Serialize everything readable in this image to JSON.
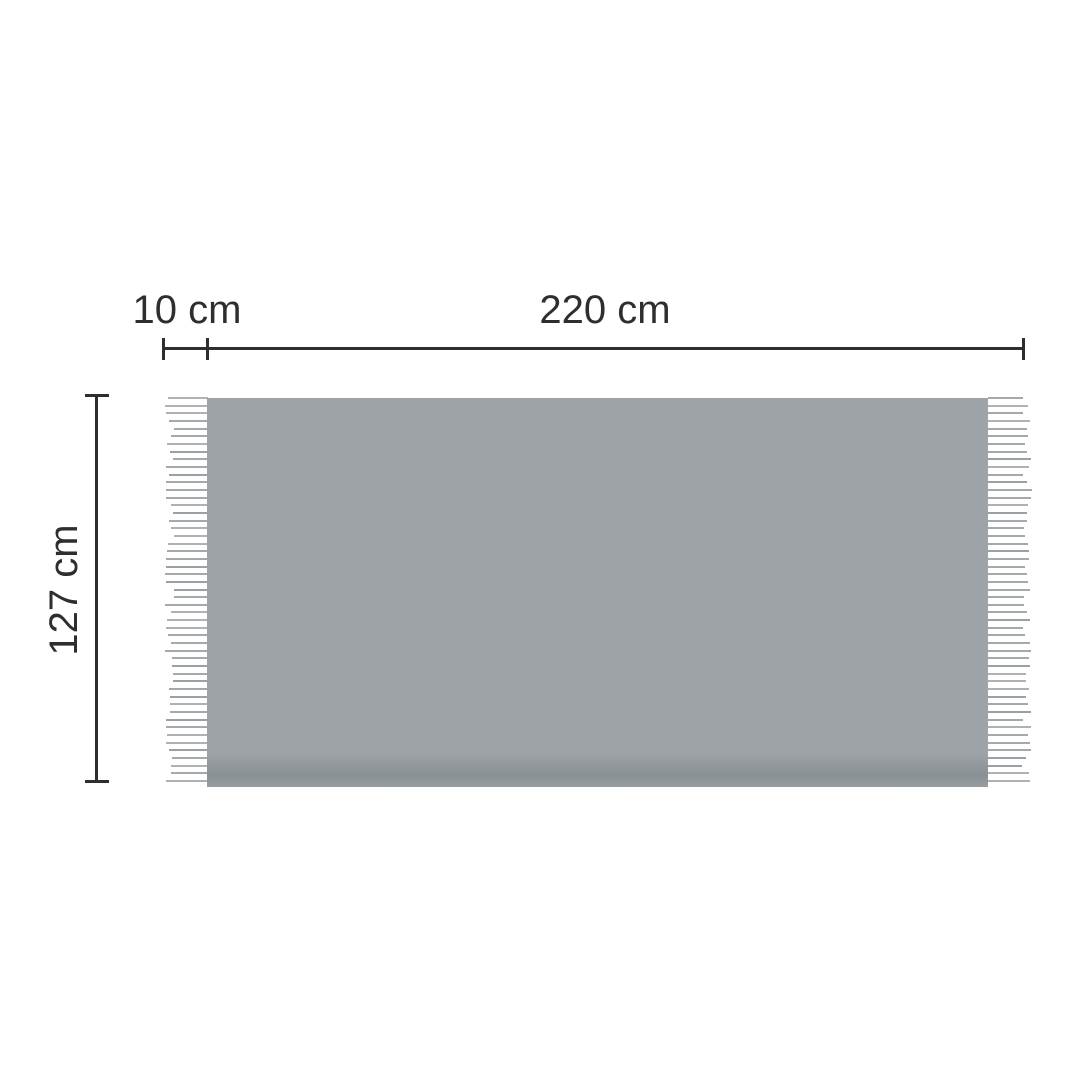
{
  "diagram": {
    "title": "blanket-dimension-diagram",
    "labels": {
      "fringe_width": "10 cm",
      "body_width": "220 cm",
      "height": "127 cm"
    },
    "colors": {
      "background": "#ffffff",
      "body_gray": "#9da3a6",
      "body_shadow": "#8a9194",
      "fringe_gray": "#a4a9ac",
      "dimension": "#2e2e2e"
    }
  }
}
